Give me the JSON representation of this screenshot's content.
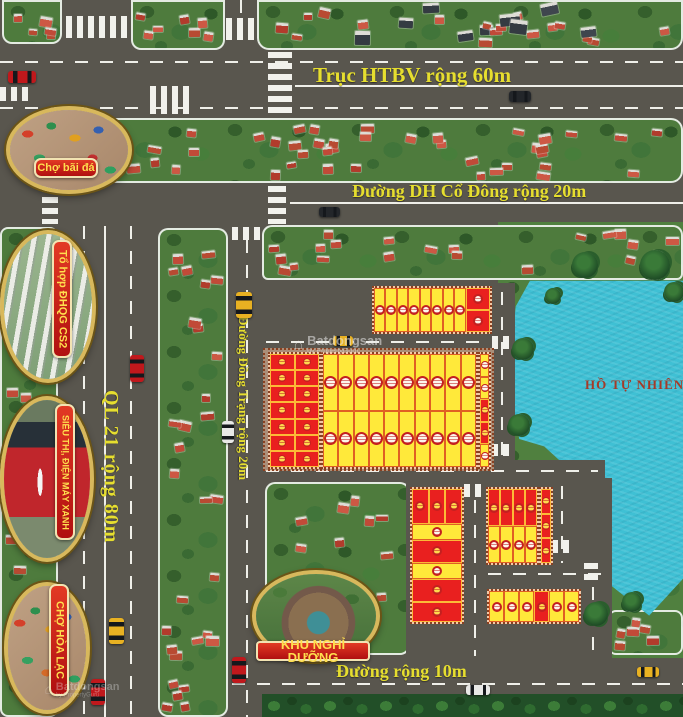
{
  "roads": {
    "truc_htbv": "Trục HTBV rộng 60m",
    "dh_co_dong": "Đường DH Cổ Đông rộng 20m",
    "ql21": "QL 21 rộng 80m",
    "dong_trang": "Đường Đồng Trạng rộng 20m",
    "duong_10m": "Đường rộng 10m"
  },
  "landmarks": {
    "cho_bai_da": "Chợ bãi đá",
    "to_hop_dhqg": "Tổ hợp ĐHQG CS2",
    "sieu_thi": "SIÊU THỊ, ĐIỆN MÁY XANH",
    "cho_hoa_lac": "CHỢ HÒA LẠC",
    "khu_nghi_duong": "KHU NGHỈ DƯỠNG"
  },
  "lake": {
    "label": "HỒ TỰ NHIÊN"
  },
  "watermark": {
    "logo": "⌂",
    "brand": "Batdongsan",
    "sub": "by PropertyGuru"
  },
  "colors": {
    "road": "#59564e",
    "lane_marking": "#efefe9",
    "label_yellow": "#e6de2f",
    "plot_yellow": "#ffe93a",
    "plot_red": "#e9201f",
    "lake": "#3fc0d4",
    "lake_label": "#a53a28",
    "badge_red": "#c51b15",
    "badge_text": "#ffdf4e",
    "oval_gold": "#d8b85c"
  },
  "plot_blocks": [
    {
      "id": "block-a",
      "x": 372,
      "y": 286,
      "w": 120,
      "h": 48,
      "mode": "cols",
      "items": [
        {
          "f": 1,
          "cells": [
            "y.w"
          ]
        },
        {
          "f": 1,
          "cells": [
            "y.w"
          ]
        },
        {
          "f": 1,
          "cells": [
            "y.w"
          ]
        },
        {
          "f": 1,
          "cells": [
            "y.w"
          ]
        },
        {
          "f": 1,
          "cells": [
            "y.w"
          ]
        },
        {
          "f": 1,
          "cells": [
            "y.w"
          ]
        },
        {
          "f": 1,
          "cells": [
            "y.w"
          ]
        },
        {
          "f": 1,
          "cells": [
            "y.w"
          ]
        },
        {
          "f": 2.1,
          "cells": [
            "r.w",
            "r.w"
          ]
        }
      ]
    },
    {
      "id": "block-b-frame",
      "x": 263,
      "y": 348,
      "w": 231,
      "h": 123,
      "frame": true
    },
    {
      "id": "block-b-left",
      "x": 268,
      "y": 352,
      "w": 53,
      "h": 117,
      "mode": "cols",
      "items": [
        {
          "f": 1,
          "cells": [
            "r.g",
            "r.g",
            "r.g",
            "r.g",
            "r.g",
            "r.g",
            "r.g"
          ]
        },
        {
          "f": 1,
          "cells": [
            "r.g",
            "r.g",
            "r.g",
            "r.g",
            "r.g",
            "r.g",
            "r.g"
          ]
        }
      ]
    },
    {
      "id": "block-b-mid",
      "x": 321,
      "y": 352,
      "w": 157,
      "h": 117,
      "mode": "cols",
      "items": [
        {
          "f": 1,
          "cells": [
            "y.w",
            "y.w"
          ]
        },
        {
          "f": 1,
          "cells": [
            "y.w",
            "y.w"
          ]
        },
        {
          "f": 1,
          "cells": [
            "y.w",
            "y.w"
          ]
        },
        {
          "f": 1,
          "cells": [
            "y.w",
            "y.w"
          ]
        },
        {
          "f": 1,
          "cells": [
            "y.w",
            "y.w"
          ]
        },
        {
          "f": 1,
          "cells": [
            "y.w",
            "y.w"
          ]
        },
        {
          "f": 1,
          "cells": [
            "y.w",
            "y.w"
          ]
        },
        {
          "f": 1,
          "cells": [
            "y.w",
            "y.w"
          ]
        },
        {
          "f": 1,
          "cells": [
            "y.w",
            "y.w"
          ]
        },
        {
          "f": 1,
          "cells": [
            "y.w",
            "y.w"
          ]
        }
      ]
    },
    {
      "id": "block-b-right",
      "x": 478,
      "y": 352,
      "w": 13,
      "h": 117,
      "mode": "cols",
      "items": [
        {
          "f": 1,
          "cells": [
            "y.w",
            "y.w",
            "r.g",
            "r.g",
            "y.w"
          ]
        }
      ]
    },
    {
      "id": "block-c",
      "x": 410,
      "y": 487,
      "w": 54,
      "h": 137,
      "mode": "rows",
      "items": [
        {
          "f": 1.7,
          "cells": [
            "r.g",
            "r.g",
            "r.g"
          ]
        },
        {
          "f": 0.8,
          "cells": [
            "y.w"
          ]
        },
        {
          "f": 1.1,
          "cells": [
            "r.g"
          ]
        },
        {
          "f": 0.8,
          "cells": [
            "y.w"
          ]
        },
        {
          "f": 1.1,
          "cells": [
            "r.g"
          ]
        },
        {
          "f": 1.0,
          "cells": [
            "r.g"
          ]
        }
      ]
    },
    {
      "id": "block-d",
      "x": 486,
      "y": 487,
      "w": 53,
      "h": 78,
      "mode": "rows",
      "items": [
        {
          "f": 1,
          "cells": [
            "r.g",
            "r.g",
            "r.g",
            "r.g"
          ]
        },
        {
          "f": 1,
          "cells": [
            "y.w",
            "y.w",
            "y.w",
            "y.w"
          ]
        }
      ]
    },
    {
      "id": "block-d2",
      "x": 539,
      "y": 487,
      "w": 14,
      "h": 78,
      "mode": "rows",
      "items": [
        {
          "f": 1,
          "cells": [
            "r.g"
          ]
        },
        {
          "f": 1,
          "cells": [
            "r.g"
          ]
        },
        {
          "f": 1,
          "cells": [
            "r.g"
          ]
        }
      ]
    },
    {
      "id": "block-e",
      "x": 487,
      "y": 589,
      "w": 94,
      "h": 35,
      "mode": "cols",
      "items": [
        {
          "f": 1,
          "cells": [
            "y.w"
          ]
        },
        {
          "f": 1,
          "cells": [
            "y.w"
          ]
        },
        {
          "f": 1,
          "cells": [
            "y.w"
          ]
        },
        {
          "f": 1,
          "cells": [
            "r.g"
          ]
        },
        {
          "f": 1,
          "cells": [
            "y.w"
          ]
        },
        {
          "f": 1,
          "cells": [
            "y.w"
          ]
        }
      ]
    }
  ]
}
